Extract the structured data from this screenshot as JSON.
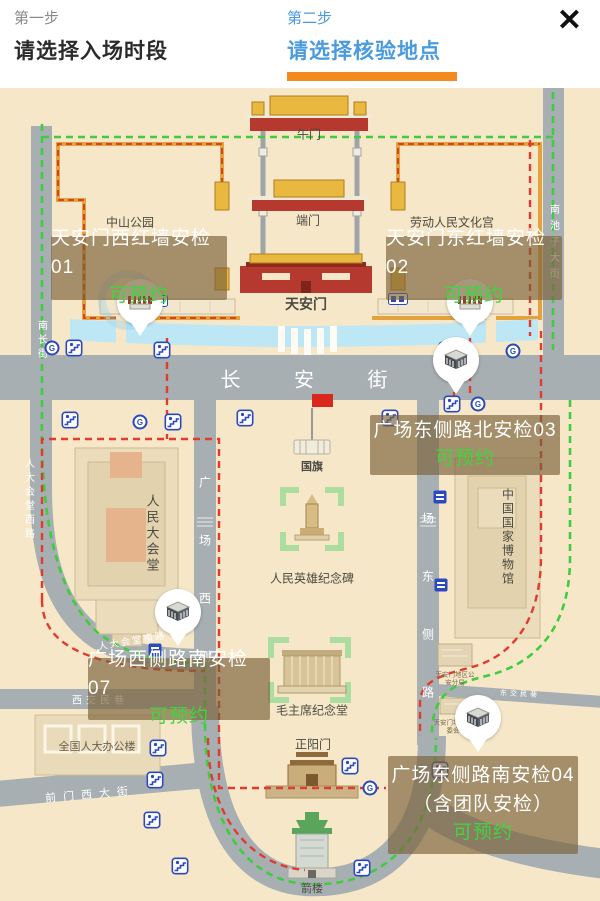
{
  "header": {
    "close_label": "✕",
    "steps": [
      {
        "step": "第一步",
        "title": "请选择入场时段",
        "active": false
      },
      {
        "step": "第二步",
        "title": "请选择核验地点",
        "active": true
      }
    ]
  },
  "colors": {
    "accent_orange": "#F28A1D",
    "active_blue": "#4A9AE0",
    "status_green": "#3FD53F",
    "route_green": "#3FCC3F",
    "route_red": "#E23B2E",
    "map_background": "#F6E7C8",
    "road_gray": "#A7AFB2"
  },
  "map": {
    "streets": {
      "changan": "长 安 街",
      "nanchang": "南长街",
      "nanchizi": "南池子大街",
      "renda_xilu": "人大会堂西路",
      "renda_nanlu": "人大会堂南路",
      "guangchang_xice": "广场西侧",
      "guangchang_dongce": "场东侧路",
      "xijiaominxiang": "西交民巷",
      "qianmen_xidajie": "前门西大街",
      "dongjiaominxiang": "东交民巷"
    },
    "places": {
      "wumen": "午门",
      "duanmen": "端门",
      "tiananmen": "天安门",
      "zhongshan_park": "中山公园",
      "wenhuagong": "劳动人民文化宫",
      "guoqi": "国旗",
      "great_hall": "人民大会堂",
      "monument": "人民英雄纪念碑",
      "museum": "中国国家博物馆",
      "mao_memorial": "毛主席纪念堂",
      "zhengyangmen": "正阳门",
      "jianlou": "箭楼",
      "npc_office": "全国人大办公楼",
      "psb": "天安门地区公安分局",
      "mgmt": "天安门地区管委会"
    },
    "checkpoints": [
      {
        "id": "01",
        "name": "天安门西红墙安检01",
        "status": "可预约"
      },
      {
        "id": "02",
        "name": "天安门东红墙安检02",
        "status": "可预约"
      },
      {
        "id": "03",
        "name": "广场东侧路北安检03",
        "status": "可预约"
      },
      {
        "id": "07",
        "name": "广场西侧路南安检07",
        "status": "可预约"
      },
      {
        "id": "04",
        "name": "广场东侧路南安检04",
        "extra": "（含团队安检）",
        "status": "可预约"
      }
    ],
    "icon_legend": {
      "subway": "subway-logo-icon",
      "underpass": "pedestrian-underpass-icon",
      "checkpoint_pin": "checkpoint-pin"
    }
  }
}
